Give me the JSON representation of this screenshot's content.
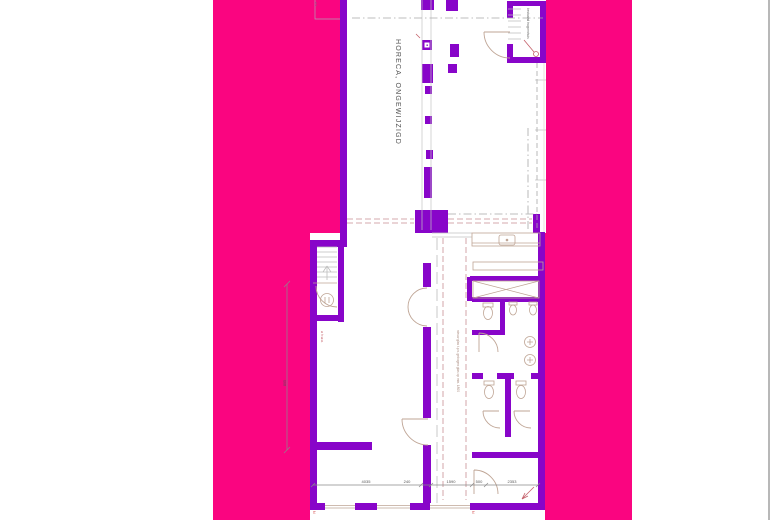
{
  "page": {
    "background": "#ffffff",
    "border_color": "#b8b8b8"
  },
  "colors": {
    "backdrop_pink": "#fa0580",
    "wall_purple": "#8805c9",
    "fixture_tan": "#bfa595",
    "guide_gray": "#b9b9b9",
    "dash_rose": "#c98f93",
    "accent_red": "#c4606a",
    "text_gray": "#4f4f4f"
  },
  "plan": {
    "title": "HORECA, ONGEWIJZIGD",
    "stair_note": "bestaand trappenhuis",
    "corridor_note": "nieuw glas t.p.v. gebogen glas op min. 1800",
    "hwa_label": "⌀ h.w.a.",
    "grid_mark": "2.1",
    "left_dim": "805",
    "north_mark": "N",
    "dims_bottom": [
      "4035",
      "240",
      "1590",
      "500",
      "2353"
    ]
  }
}
